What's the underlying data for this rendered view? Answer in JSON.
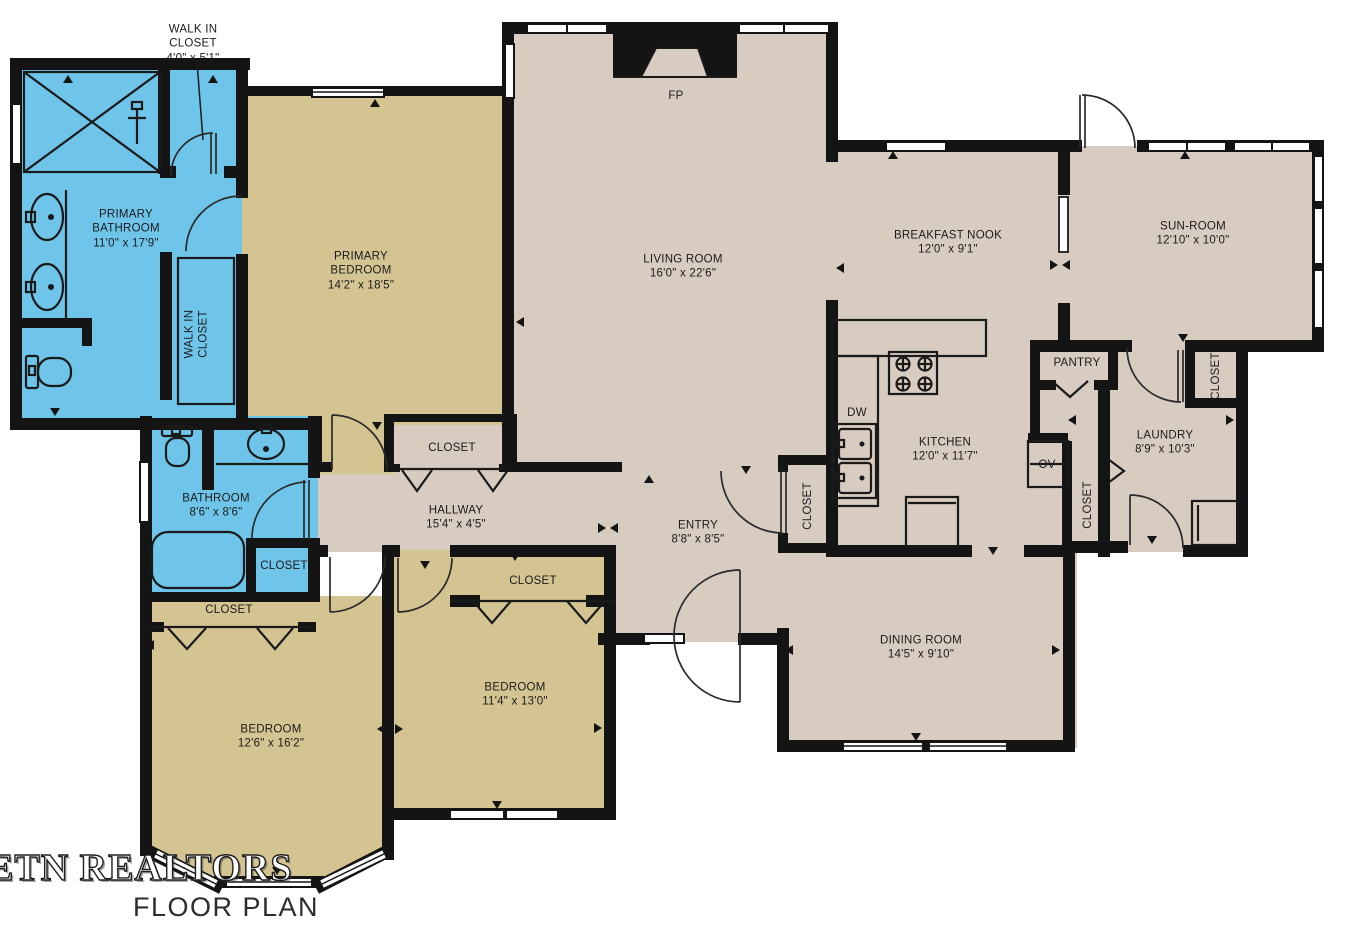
{
  "branding": {
    "watermark": "ETN REALTORS",
    "caption": "FLOOR PLAN"
  },
  "colors": {
    "bathroom_fill": "#6FC5E9",
    "bedroom_fill": "#D3C492",
    "living_fill": "#D8CBBF",
    "wall": "#141414",
    "background": "#FFFFFF"
  },
  "rooms": {
    "walk_in_closet_main": {
      "name": "WALK IN CLOSET",
      "dims": "4'0\" x 5'1\""
    },
    "primary_bathroom": {
      "name": "PRIMARY BATHROOM",
      "dims": "11'0\" x 17'9\""
    },
    "walk_in_closet_2": {
      "name": "WALK IN CLOSET"
    },
    "primary_bedroom": {
      "name": "PRIMARY BEDROOM",
      "dims": "14'2\" x 18'5\""
    },
    "living_room": {
      "name": "LIVING ROOM",
      "dims": "16'0\" x 22'6\""
    },
    "breakfast_nook": {
      "name": "BREAKFAST NOOK",
      "dims": "12'0\" x 9'1\""
    },
    "sun_room": {
      "name": "SUN-ROOM",
      "dims": "12'10\" x 10'0\""
    },
    "kitchen": {
      "name": "KITCHEN",
      "dims": "12'0\" x 11'7\""
    },
    "pantry": {
      "name": "PANTRY"
    },
    "laundry": {
      "name": "LAUNDRY",
      "dims": "8'9\" x 10'3\""
    },
    "hallway": {
      "name": "HALLWAY",
      "dims": "15'4\" x 4'5\""
    },
    "entry": {
      "name": "ENTRY",
      "dims": "8'8\" x 8'5\""
    },
    "dining_room": {
      "name": "DINING ROOM",
      "dims": "14'5\" x 9'10\""
    },
    "bathroom": {
      "name": "BATHROOM",
      "dims": "8'6\" x 8'6\""
    },
    "bedroom_1": {
      "name": "BEDROOM",
      "dims": "12'6\" x 16'2\""
    },
    "bedroom_2": {
      "name": "BEDROOM",
      "dims": "11'4\" x 13'0\""
    }
  },
  "closets": {
    "hall": "CLOSET",
    "bathroom": "CLOSET",
    "bedroom_1": "CLOSET",
    "bedroom_2": "CLOSET",
    "entry": "CLOSET",
    "laundry_side": "CLOSET",
    "sun_room_side": "CLOSET"
  },
  "appliances": {
    "fireplace": "FP",
    "dishwasher": "DW",
    "oven": "OV"
  }
}
